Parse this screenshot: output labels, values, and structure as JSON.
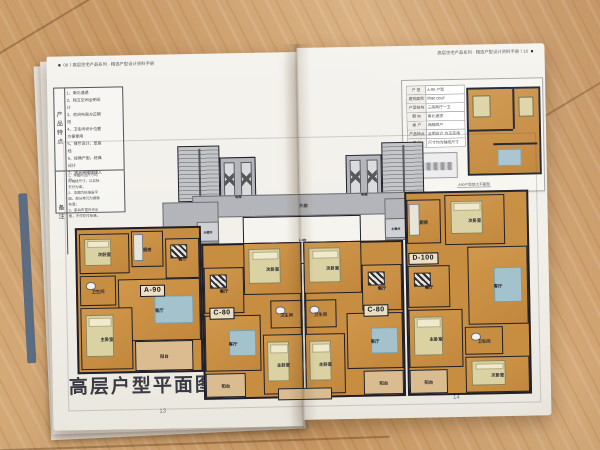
{
  "colors": {
    "wood": "#c99e6b",
    "paper": "#f1efe8",
    "wall": "#1f1f2b",
    "unit_fill": "#c78e41",
    "core_fill": "#b3b5ba",
    "balcony_fill": "#dabc90",
    "rug": "#a4c2cc",
    "bed": "#dbd2a4",
    "void_fill": "#f6f4ee",
    "red": "#a93a2c",
    "ink": "#2c2c34"
  },
  "left_page": {
    "header_mark": "■",
    "header_text": "09丨高层住宅产品系列 · 精选户型设计资料手册",
    "features": {
      "row_header": "产品特点",
      "items": [
        "1、南北通透",
        "2、独立空间全明设计",
        "3、房间布局方正朝阳",
        "4、卫生间设计位置方便使用",
        "5、餐厅设计，显高档",
        "6、经典户型，经典设计",
        "7、观光电梯便捷入户"
      ]
    },
    "notes": {
      "row_header": "备注",
      "items": [
        "1、本图所注尺寸均为轴线尺寸，以实际交付为准；",
        "2、本图为标准层平面，部分单元为镜像布置；",
        "3、家具布置仅作示意，不作交付标准。"
      ]
    },
    "title": "高层户型平面图",
    "page_number": "13"
  },
  "right_page": {
    "header_text": "高层住宅产品系列 · 精选户型设计资料手册丨10",
    "header_mark": "■",
    "inset": {
      "table_rows": [
        [
          "户 型",
          "A-90 户型"
        ],
        [
          "建筑面积",
          "约90.00㎡"
        ],
        [
          "户型结构",
          "三房两厅一卫"
        ],
        [
          "朝 向",
          "南北通透"
        ],
        [
          "梯 户",
          "两梯四户"
        ],
        [
          "产品特点",
          "全明设计·方正实用"
        ],
        [
          "备 注",
          "尺寸均为轴线尺寸"
        ]
      ],
      "caption": "A90户型放大平面图"
    },
    "page_number": "14"
  },
  "floor_plan": {
    "areas": [
      {
        "id": "stair-left",
        "label": "",
        "type": "stair",
        "x": 104,
        "y": 0,
        "w": 42,
        "h": 56
      },
      {
        "id": "elev-left",
        "label": "电梯",
        "type": "elev",
        "x": 146,
        "y": 12,
        "w": 36,
        "h": 44
      },
      {
        "id": "stair-right",
        "label": "",
        "type": "stair",
        "x": 308,
        "y": 0,
        "w": 42,
        "h": 56
      },
      {
        "id": "elev-right",
        "label": "电梯",
        "type": "elev",
        "x": 272,
        "y": 12,
        "w": 36,
        "h": 44
      },
      {
        "id": "corridor",
        "label": "外廊",
        "type": "core",
        "x": 118,
        "y": 50,
        "w": 222,
        "h": 22
      },
      {
        "id": "lobby-left",
        "label": "",
        "type": "core",
        "x": 88,
        "y": 56,
        "w": 56,
        "h": 42
      },
      {
        "id": "lobby-right",
        "label": "",
        "type": "core",
        "x": 310,
        "y": 56,
        "w": 56,
        "h": 42
      },
      {
        "id": "shaft-left",
        "label": "水暖井",
        "type": "shaft",
        "x": 122,
        "y": 76,
        "w": 22,
        "h": 20
      },
      {
        "id": "shaft-right",
        "label": "水暖井",
        "type": "shaft",
        "x": 310,
        "y": 76,
        "w": 22,
        "h": 20
      },
      {
        "id": "void",
        "label": "上空",
        "type": "void",
        "x": 168,
        "y": 72,
        "w": 118,
        "h": 48
      },
      {
        "id": "unit-a90",
        "label": "",
        "type": "unitbg",
        "x": 0,
        "y": 80,
        "w": 126,
        "h": 146
      },
      {
        "id": "unit-c80l",
        "label": "",
        "type": "unitbg",
        "x": 126,
        "y": 98,
        "w": 100,
        "h": 156
      },
      {
        "id": "unit-c80r",
        "label": "",
        "type": "unitbg",
        "x": 228,
        "y": 98,
        "w": 100,
        "h": 156
      },
      {
        "id": "unit-d100",
        "label": "",
        "type": "unitbg",
        "x": 330,
        "y": 50,
        "w": 124,
        "h": 204
      },
      {
        "id": "a90-bed2",
        "label": "次卧室",
        "type": "bedroom",
        "x": 4,
        "y": 86,
        "w": 50,
        "h": 40
      },
      {
        "id": "a90-kitchen",
        "label": "厨房",
        "type": "kitchen",
        "x": 56,
        "y": 84,
        "w": 32,
        "h": 36
      },
      {
        "id": "a90-dining",
        "label": "餐厅",
        "type": "dining",
        "x": 90,
        "y": 92,
        "w": 34,
        "h": 40
      },
      {
        "id": "a90-bath",
        "label": "卫生间",
        "type": "bath",
        "x": 4,
        "y": 128,
        "w": 36,
        "h": 30
      },
      {
        "id": "a90-living",
        "label": "客厅",
        "type": "living",
        "x": 42,
        "y": 132,
        "w": 82,
        "h": 62
      },
      {
        "id": "a90-bed1",
        "label": "主卧室",
        "type": "bedroom",
        "x": 4,
        "y": 160,
        "w": 52,
        "h": 62
      },
      {
        "id": "a90-balcony",
        "label": "阳台",
        "type": "balcony",
        "x": 58,
        "y": 194,
        "w": 58,
        "h": 30
      },
      {
        "id": "c80l-bed2",
        "label": "次卧室",
        "type": "bedroom",
        "x": 168,
        "y": 98,
        "w": 58,
        "h": 52
      },
      {
        "id": "c80l-dining",
        "label": "餐厅",
        "type": "dining",
        "x": 128,
        "y": 122,
        "w": 40,
        "h": 46
      },
      {
        "id": "c80l-bath",
        "label": "卫生间",
        "type": "bath",
        "x": 194,
        "y": 156,
        "w": 32,
        "h": 28
      },
      {
        "id": "c80l-living",
        "label": "客厅",
        "type": "living",
        "x": 128,
        "y": 170,
        "w": 56,
        "h": 56
      },
      {
        "id": "c80l-bed1",
        "label": "主卧室",
        "type": "bedroom",
        "x": 186,
        "y": 190,
        "w": 40,
        "h": 60
      },
      {
        "id": "c80l-balcony",
        "label": "阳台",
        "type": "balcony",
        "x": 128,
        "y": 228,
        "w": 40,
        "h": 24
      },
      {
        "id": "c80r-bed2",
        "label": "次卧室",
        "type": "bedroom",
        "x": 228,
        "y": 98,
        "w": 58,
        "h": 52
      },
      {
        "id": "c80r-dining",
        "label": "餐厅",
        "type": "dining",
        "x": 286,
        "y": 122,
        "w": 40,
        "h": 46
      },
      {
        "id": "c80r-bath",
        "label": "卫生间",
        "type": "bath",
        "x": 228,
        "y": 156,
        "w": 32,
        "h": 28
      },
      {
        "id": "c80r-living",
        "label": "客厅",
        "type": "living",
        "x": 270,
        "y": 170,
        "w": 56,
        "h": 56
      },
      {
        "id": "c80r-bed1",
        "label": "主卧室",
        "type": "bedroom",
        "x": 228,
        "y": 190,
        "w": 40,
        "h": 60
      },
      {
        "id": "c80r-balcony",
        "label": "阳台",
        "type": "balcony",
        "x": 286,
        "y": 228,
        "w": 40,
        "h": 24
      },
      {
        "id": "d100-kitchen",
        "label": "厨房",
        "type": "kitchen",
        "x": 332,
        "y": 58,
        "w": 34,
        "h": 44
      },
      {
        "id": "d100-bed2a",
        "label": "次卧室",
        "type": "bedroom",
        "x": 370,
        "y": 54,
        "w": 60,
        "h": 50
      },
      {
        "id": "d100-dining",
        "label": "餐厅",
        "type": "dining",
        "x": 332,
        "y": 124,
        "w": 42,
        "h": 42
      },
      {
        "id": "d100-living",
        "label": "客厅",
        "type": "living",
        "x": 392,
        "y": 106,
        "w": 60,
        "h": 78
      },
      {
        "id": "d100-bed1",
        "label": "主卧室",
        "type": "bedroom",
        "x": 332,
        "y": 168,
        "w": 54,
        "h": 58
      },
      {
        "id": "d100-bath",
        "label": "卫生间",
        "type": "bath",
        "x": 388,
        "y": 186,
        "w": 38,
        "h": 28
      },
      {
        "id": "d100-bed2b",
        "label": "次卧室",
        "type": "bedroom",
        "x": 388,
        "y": 216,
        "w": 64,
        "h": 36
      },
      {
        "id": "d100-balcony",
        "label": "阳台",
        "type": "balcony",
        "x": 332,
        "y": 228,
        "w": 38,
        "h": 24
      },
      {
        "id": "center-bay",
        "label": "",
        "type": "balcony",
        "x": 200,
        "y": 244,
        "w": 54,
        "h": 12
      }
    ],
    "unit_tags": [
      {
        "label": "A-90",
        "x": 64,
        "y": 138
      },
      {
        "label": "C-80",
        "x": 133,
        "y": 162
      },
      {
        "label": "C-80",
        "x": 287,
        "y": 162
      },
      {
        "label": "D-100",
        "x": 333,
        "y": 111
      }
    ]
  }
}
